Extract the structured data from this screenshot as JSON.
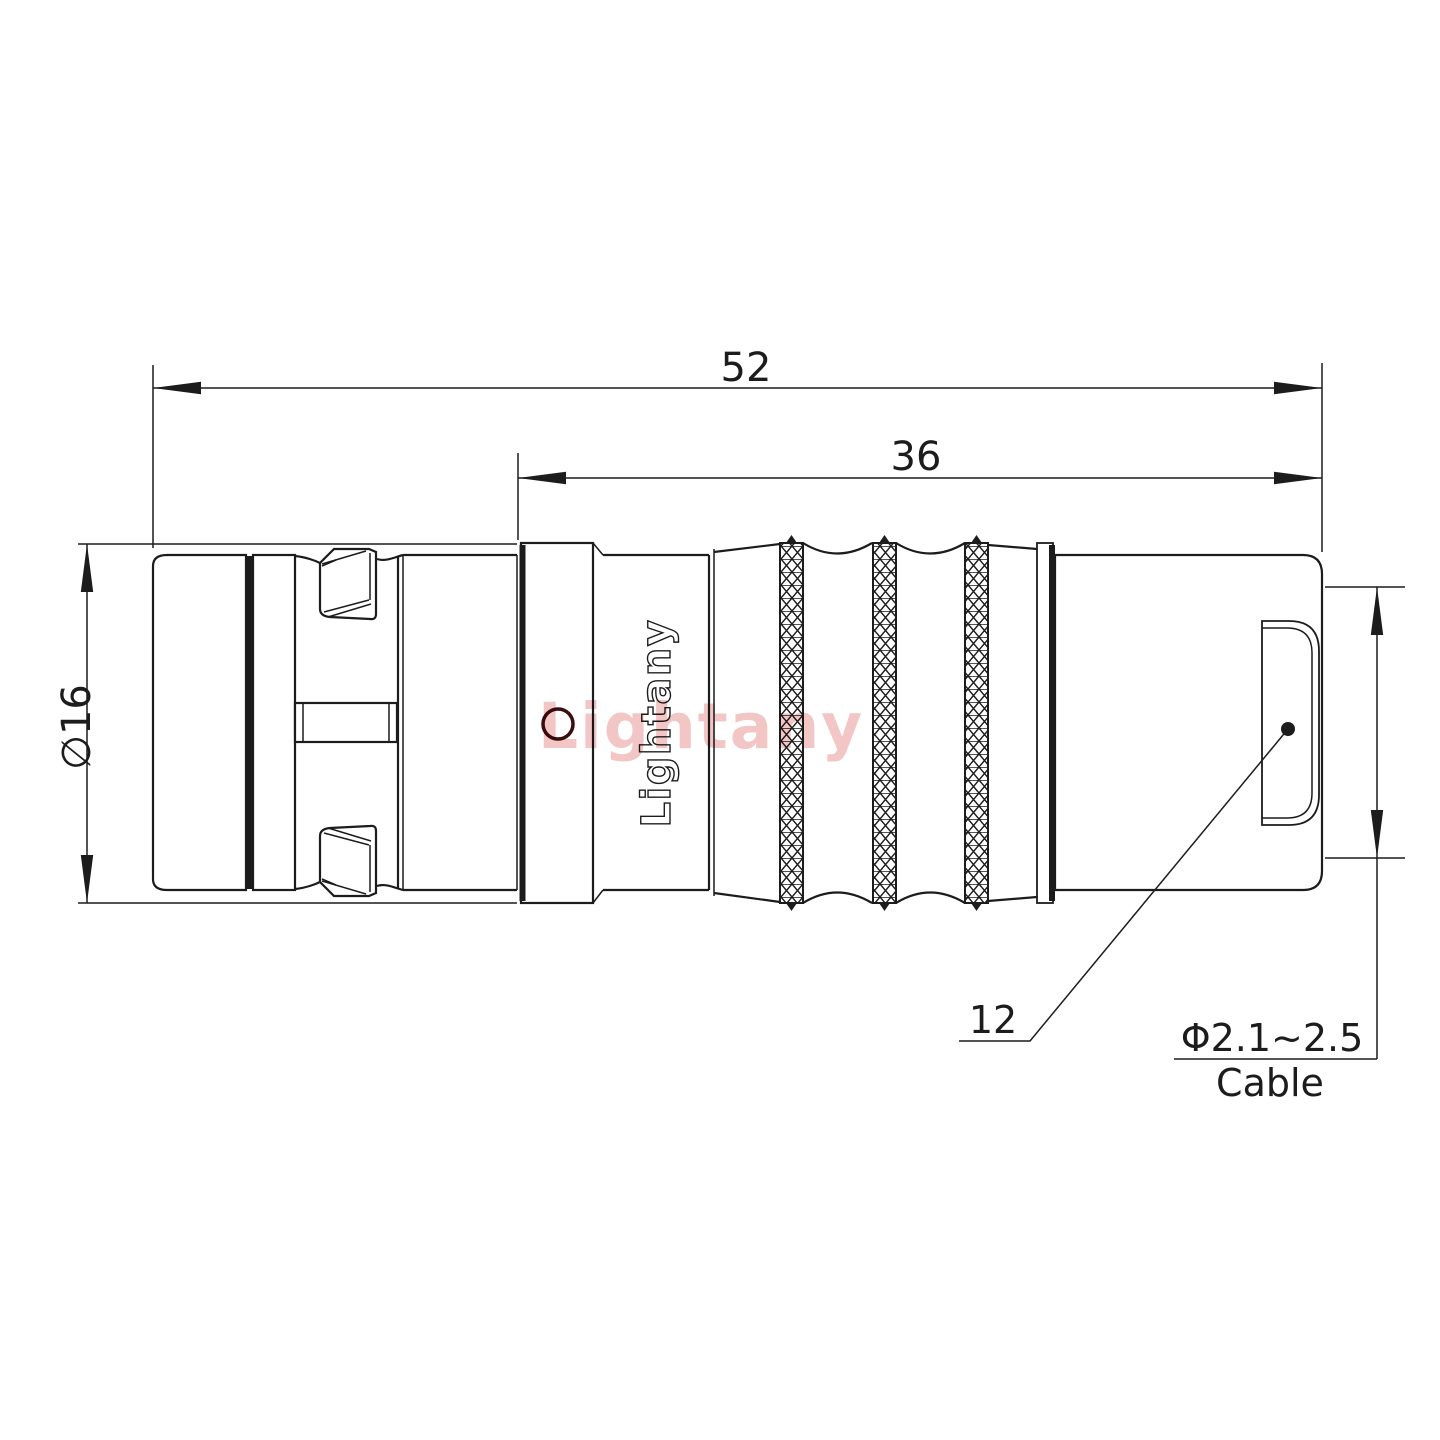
{
  "drawing": {
    "dimensions": {
      "overall_length": "52",
      "body_length": "36",
      "outer_diameter": "∅16",
      "nut_ref": "12",
      "cable_range": "Φ2.1~2.5",
      "cable_word": "Cable"
    },
    "branding": {
      "logo_vertical": "Lightany",
      "watermark": "Lightany"
    },
    "colors": {
      "line": "#1c1c1c",
      "watermark": "#f2c0c0",
      "hole_ring": "#3a0e0e",
      "background": "#ffffff"
    }
  }
}
